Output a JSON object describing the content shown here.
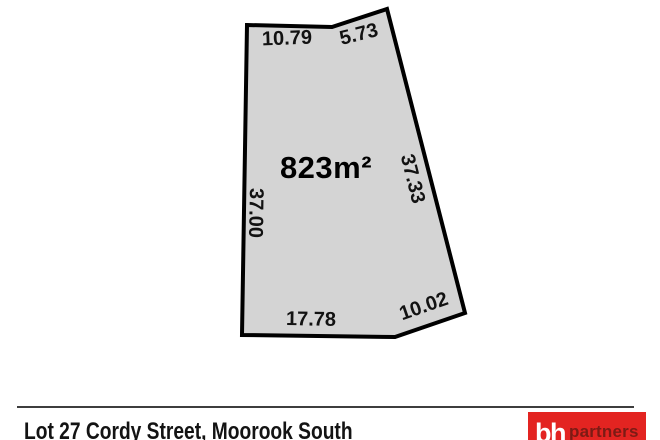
{
  "parcel": {
    "area_label": "823m²",
    "fill_color": "#d4d4d4",
    "outline_color": "#000000",
    "dimensions": {
      "top": "10.79",
      "top_right": "5.73",
      "right": "37.33",
      "left": "37.00",
      "bottom": "17.78",
      "bottom_right": "10.02"
    }
  },
  "footer": {
    "address": "Lot 27 Cordy Street, Moorook South"
  },
  "logo": {
    "glyph": "bh",
    "text": "partners",
    "background_color": "#e32421",
    "glyph_color": "#ffffff",
    "text_color": "#7c1b15"
  }
}
